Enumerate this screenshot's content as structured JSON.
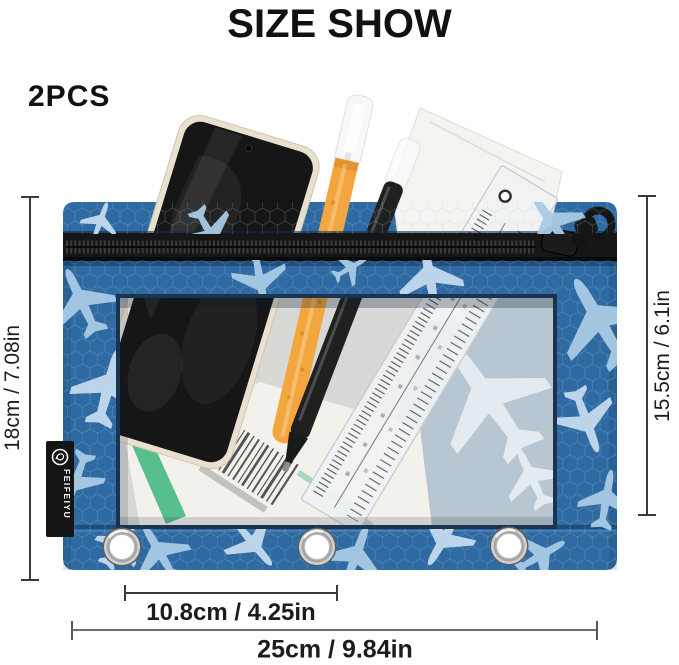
{
  "header": {
    "title": "SIZE SHOW",
    "quantity": "2PCS"
  },
  "annotations": {
    "height_total": "18cm / 7.08in",
    "height_body": "15.5cm / 6.1in",
    "grommet_spacing": "10.8cm / 4.25in",
    "width_total": "25cm / 9.84in"
  },
  "product": {
    "brand": "FEIFEIYU",
    "colors": {
      "fabric_blue": "#2f6ba2",
      "airplane_light": "#a9cbe6",
      "zipper_black": "#161616",
      "window_paper_blue_gray": "#b8c6d1",
      "pen_orange": "#f4a63e",
      "stripe_green": "#57bf8d",
      "phone_frame_cream": "#e9e1d0"
    }
  }
}
